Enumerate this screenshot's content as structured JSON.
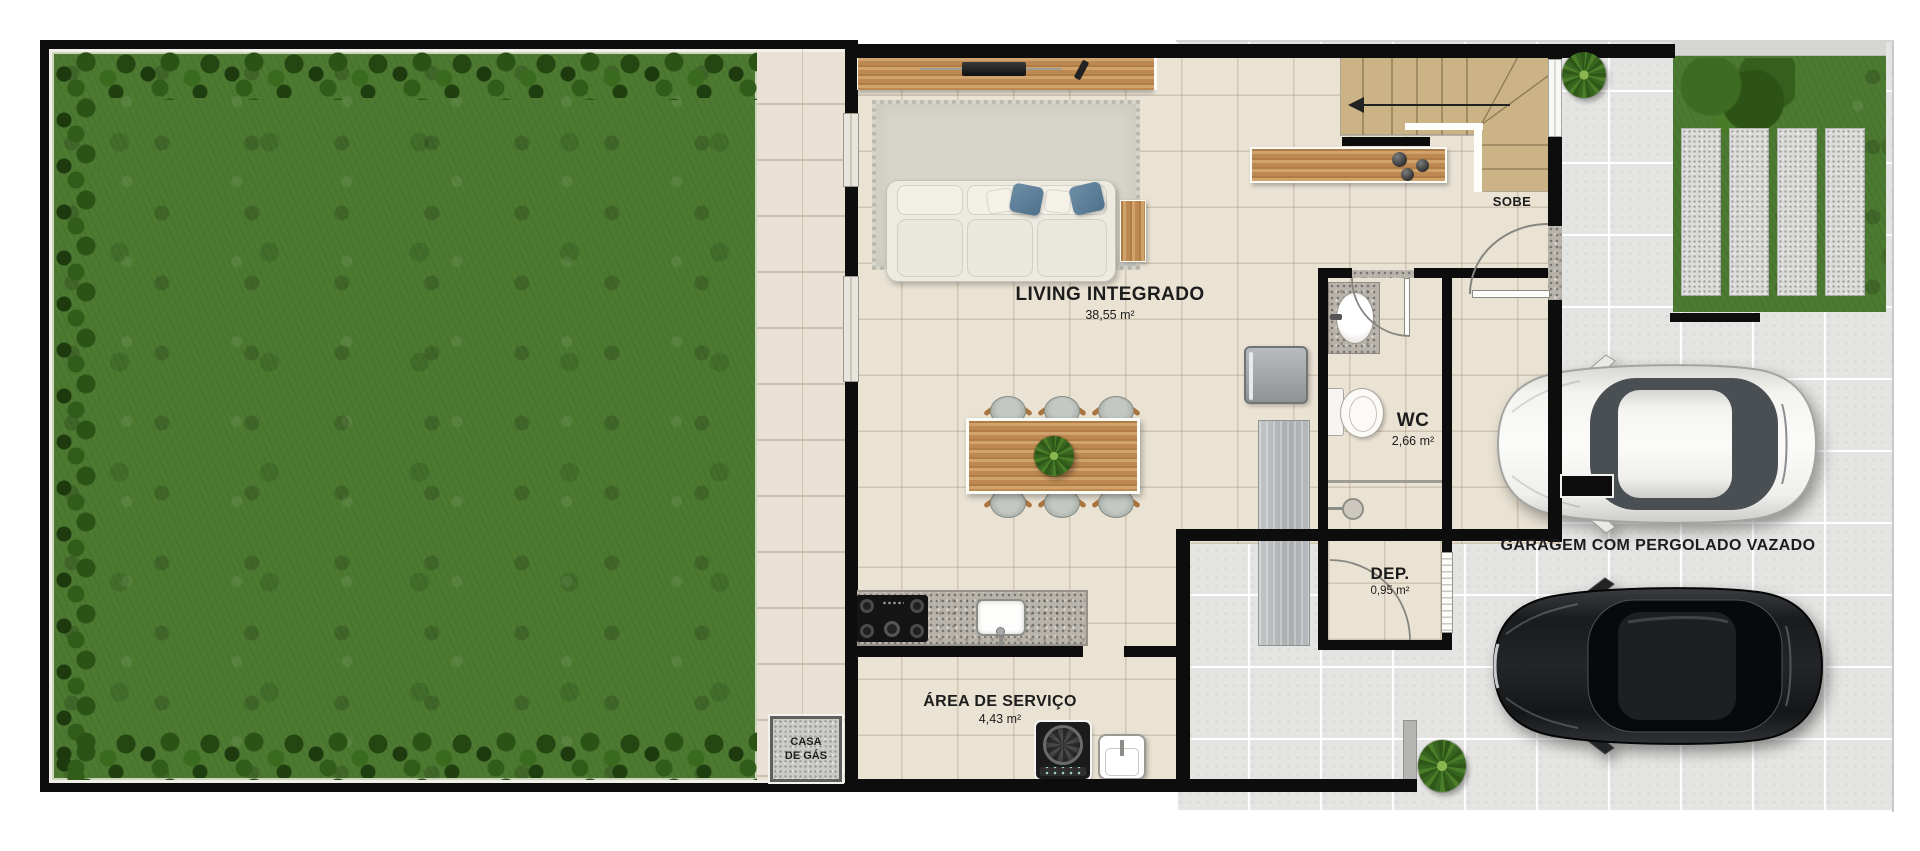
{
  "rooms": {
    "living": {
      "name": "LIVING INTEGRADO",
      "area": "38,55 m²"
    },
    "wc": {
      "name": "WC",
      "area": "2,66 m²"
    },
    "dep": {
      "name": "DEP.",
      "area": "0,95 m²"
    },
    "service": {
      "name": "ÁREA DE SERVIÇO",
      "area": "4,43 m²"
    },
    "garage": {
      "name": "GARAGEM COM PERGOLADO VAZADO"
    },
    "gas": {
      "line1": "CASA",
      "line2": "DE GÁS"
    },
    "stairs": {
      "direction": "SOBE"
    }
  },
  "palette": {
    "wall": "#0d0d0d",
    "grass": "#4d7a31",
    "hedge_dark": "#244612",
    "interior_floor": "#eae3d4",
    "garage_floor": "#e4e4e2",
    "stairs": "#ccb385",
    "wood": "#c49158",
    "granite": "#b9b4ab",
    "pillow_blue": "#5d7f99",
    "white_car": "#f5f5f2",
    "black_car": "#141618"
  }
}
